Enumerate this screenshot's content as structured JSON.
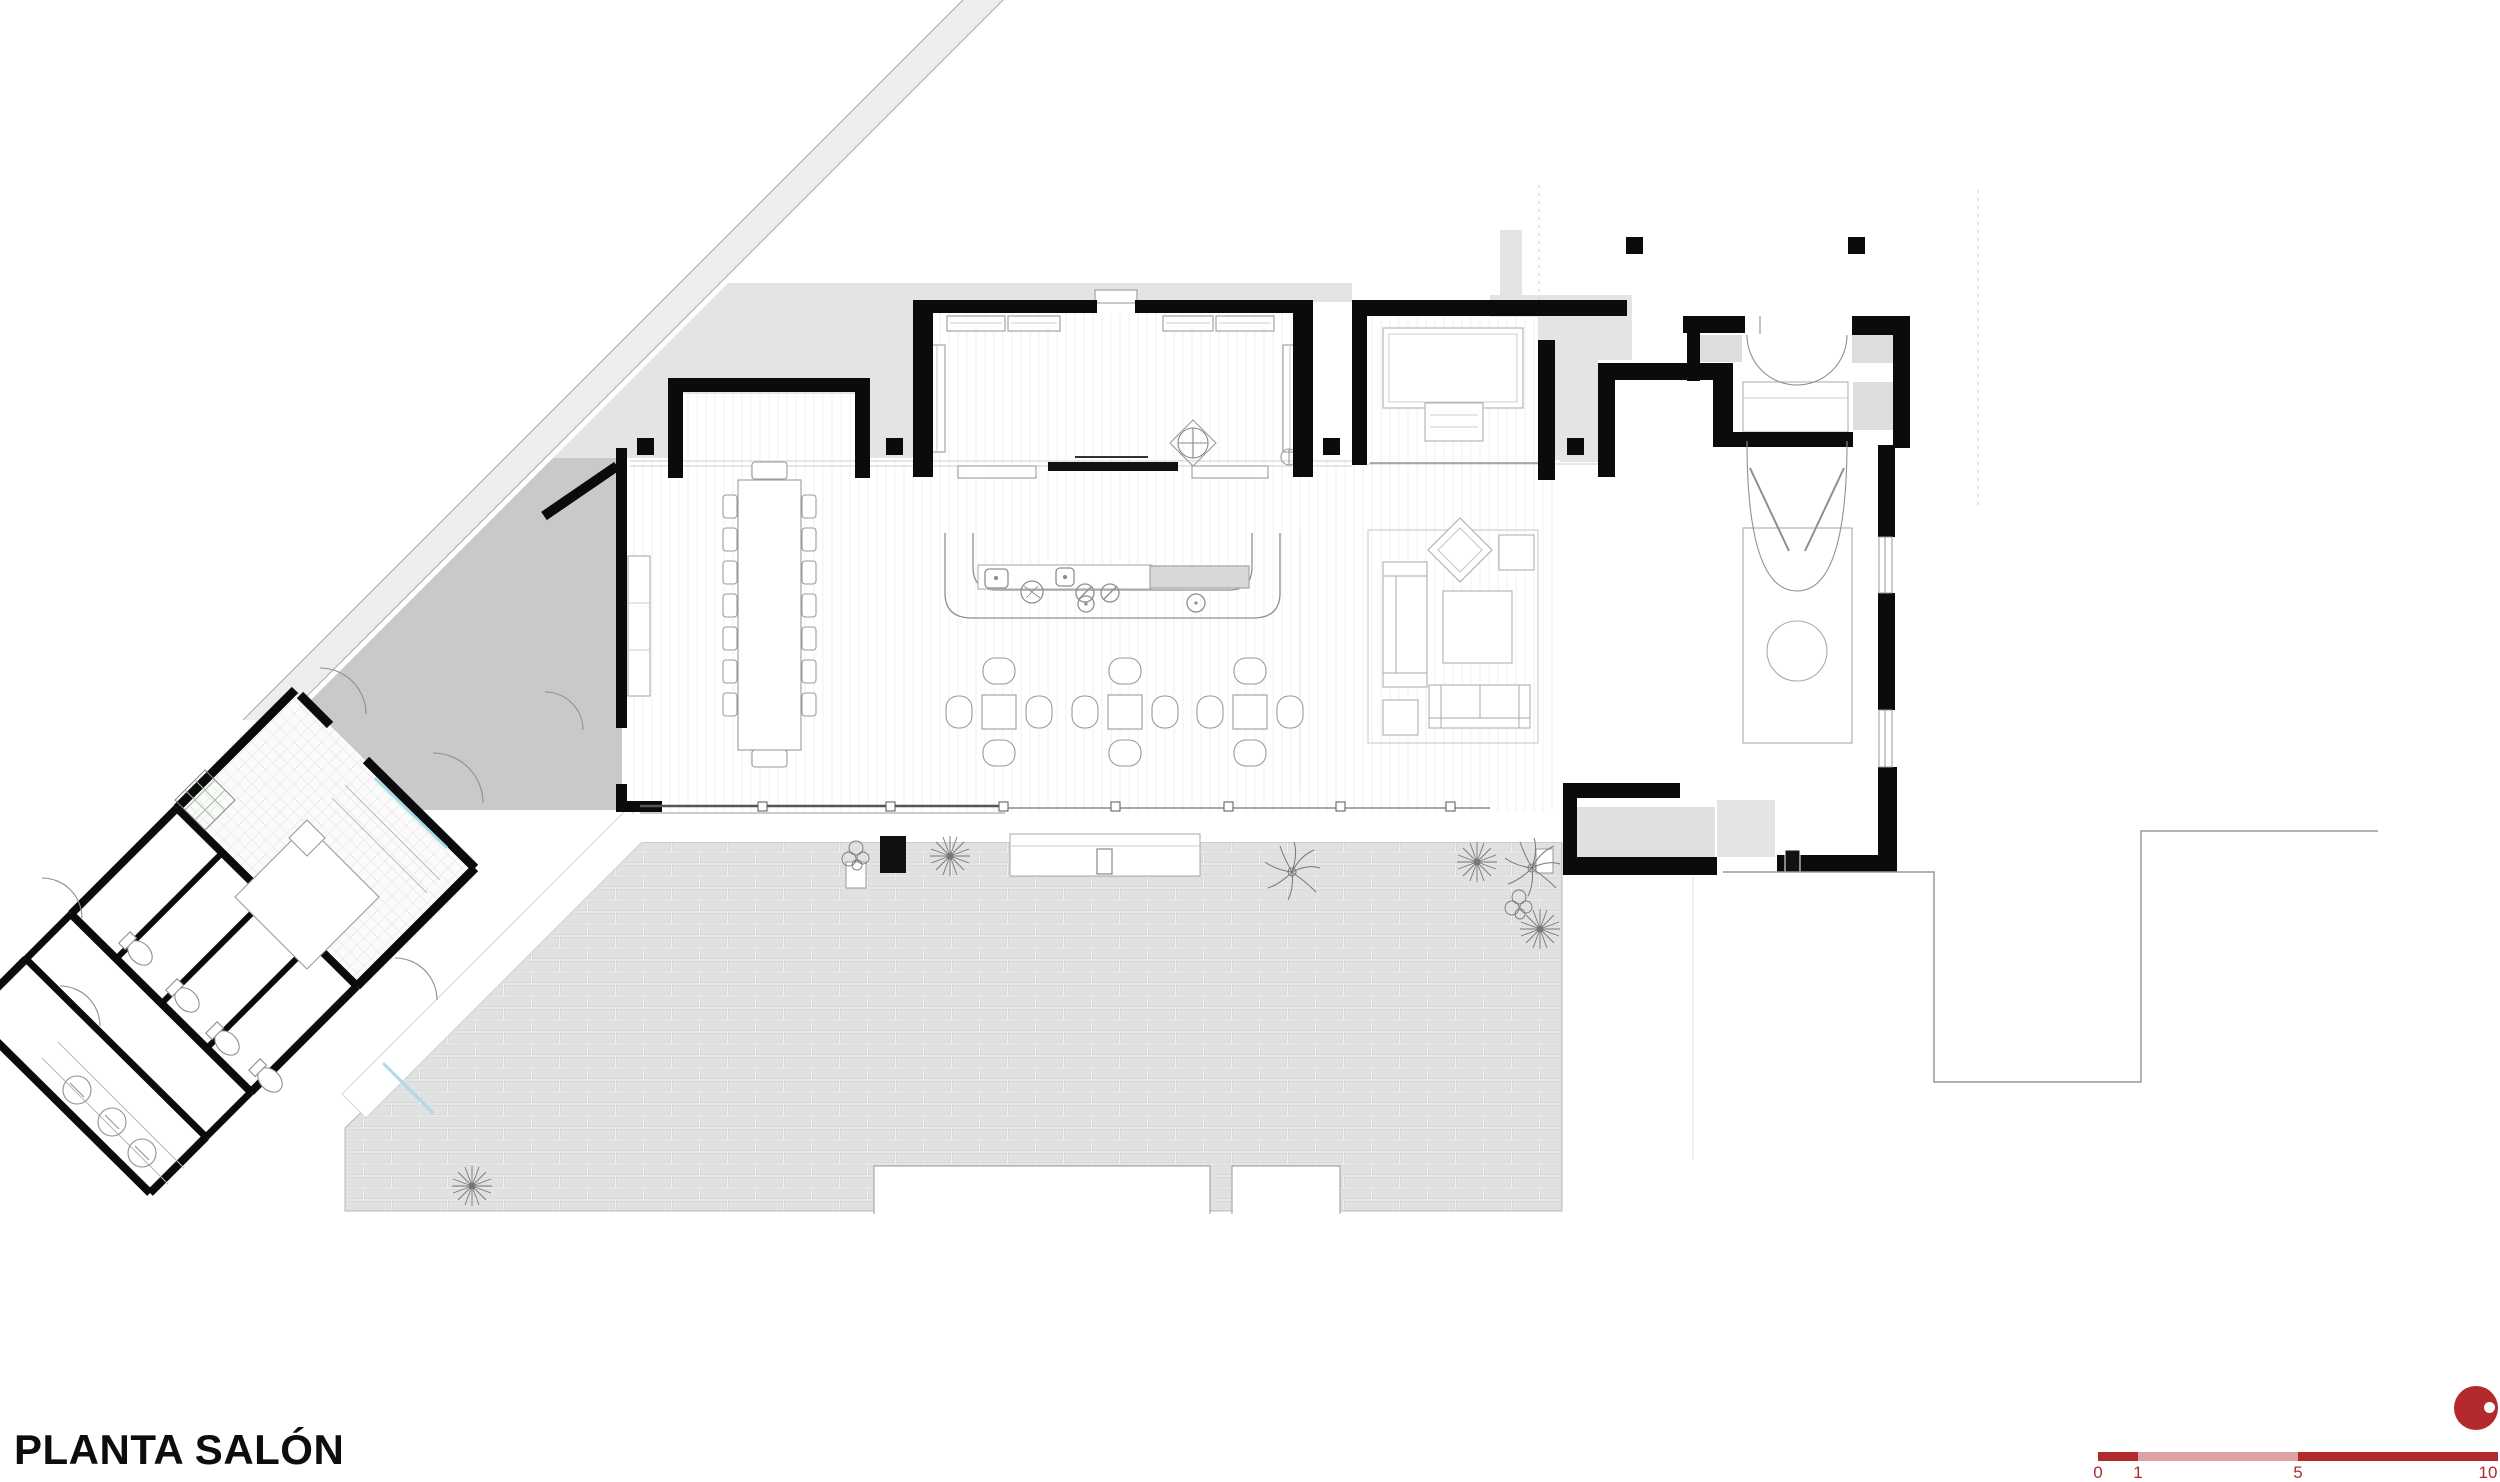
{
  "sheet": {
    "title": "PLANTA SALÓN"
  },
  "scale_bar": {
    "labels": [
      "0",
      "1",
      "5",
      "10"
    ],
    "dark_color": "#b22a2c",
    "light_color": "#dfa0a1"
  },
  "marker": {
    "color": "#b22a2c"
  },
  "palette": {
    "wall": "#0b0b0b",
    "property_band": "#ededed",
    "plaza": "#e4e4e4",
    "courtyard": "#c9c9c9",
    "brick_paving": "#e1e1e1",
    "drawing_line": "#9a9a9a",
    "glass": "#a8dcec",
    "accent_red": "#b22a2c"
  },
  "features": [
    "property-line-band",
    "service-wing",
    "dining-room",
    "stage-hall",
    "bar-counter",
    "cafe-tables",
    "living-area",
    "entry-vestibule",
    "terrace-paving",
    "palm-trees",
    "scale-bar"
  ]
}
